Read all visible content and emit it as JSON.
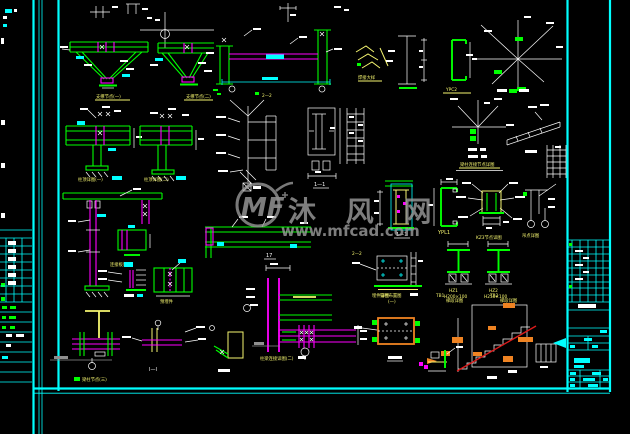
{
  "palette": {
    "background": "#000000",
    "frame_cyan": "#00ffff",
    "member_green": "#00ff00",
    "plate_magenta": "#ff00ff",
    "annotation_white": "#ffffff",
    "label_yellow": "#f6f670",
    "watermark_gray": "#9b9b9b",
    "stair_red": "#dd1c1c",
    "tread_orange": "#ef8322"
  },
  "watermark": {
    "logo": "MF",
    "brand": "沐 风 网",
    "url": "www.mfcad.com"
  },
  "labels": {
    "truss1": "支撑节点(一)",
    "truss2": "支撑节点(二)",
    "weld_sketch": "焊接大样",
    "ypc": "YPC2",
    "radial_node": "节点详图",
    "col_top1": "柱顶详图(一)",
    "col_top2": "柱顶详图(二)",
    "conn_plate": "连接板详图",
    "embed1": "预埋件",
    "beam_col3": "梁柱节点(三)",
    "sec_ii": "I—I",
    "col_frame": "柱梁连接详图(二)",
    "corner17": "17",
    "sec22": "2—2",
    "node22": "2—2",
    "anchor_plan": "锚栓布置图",
    "hz1": "HZ1",
    "hz1_spec": "H200×100",
    "hz2": "HZ2",
    "hz2_spec": "H250×100",
    "sec11a": "1—1",
    "sec11b": "1—1",
    "ypl1": "YPL1",
    "kz3": "KZ3节点详图",
    "hang": "吊点详图",
    "heading": "梁柱连接节点详图",
    "embed_plan1": "埋件详图",
    "embed_plan2": "(一)",
    "stair1a": "TB1",
    "stair1b": "梯段详图",
    "stair2a": "TB2",
    "stair2b": "梯段详图"
  }
}
